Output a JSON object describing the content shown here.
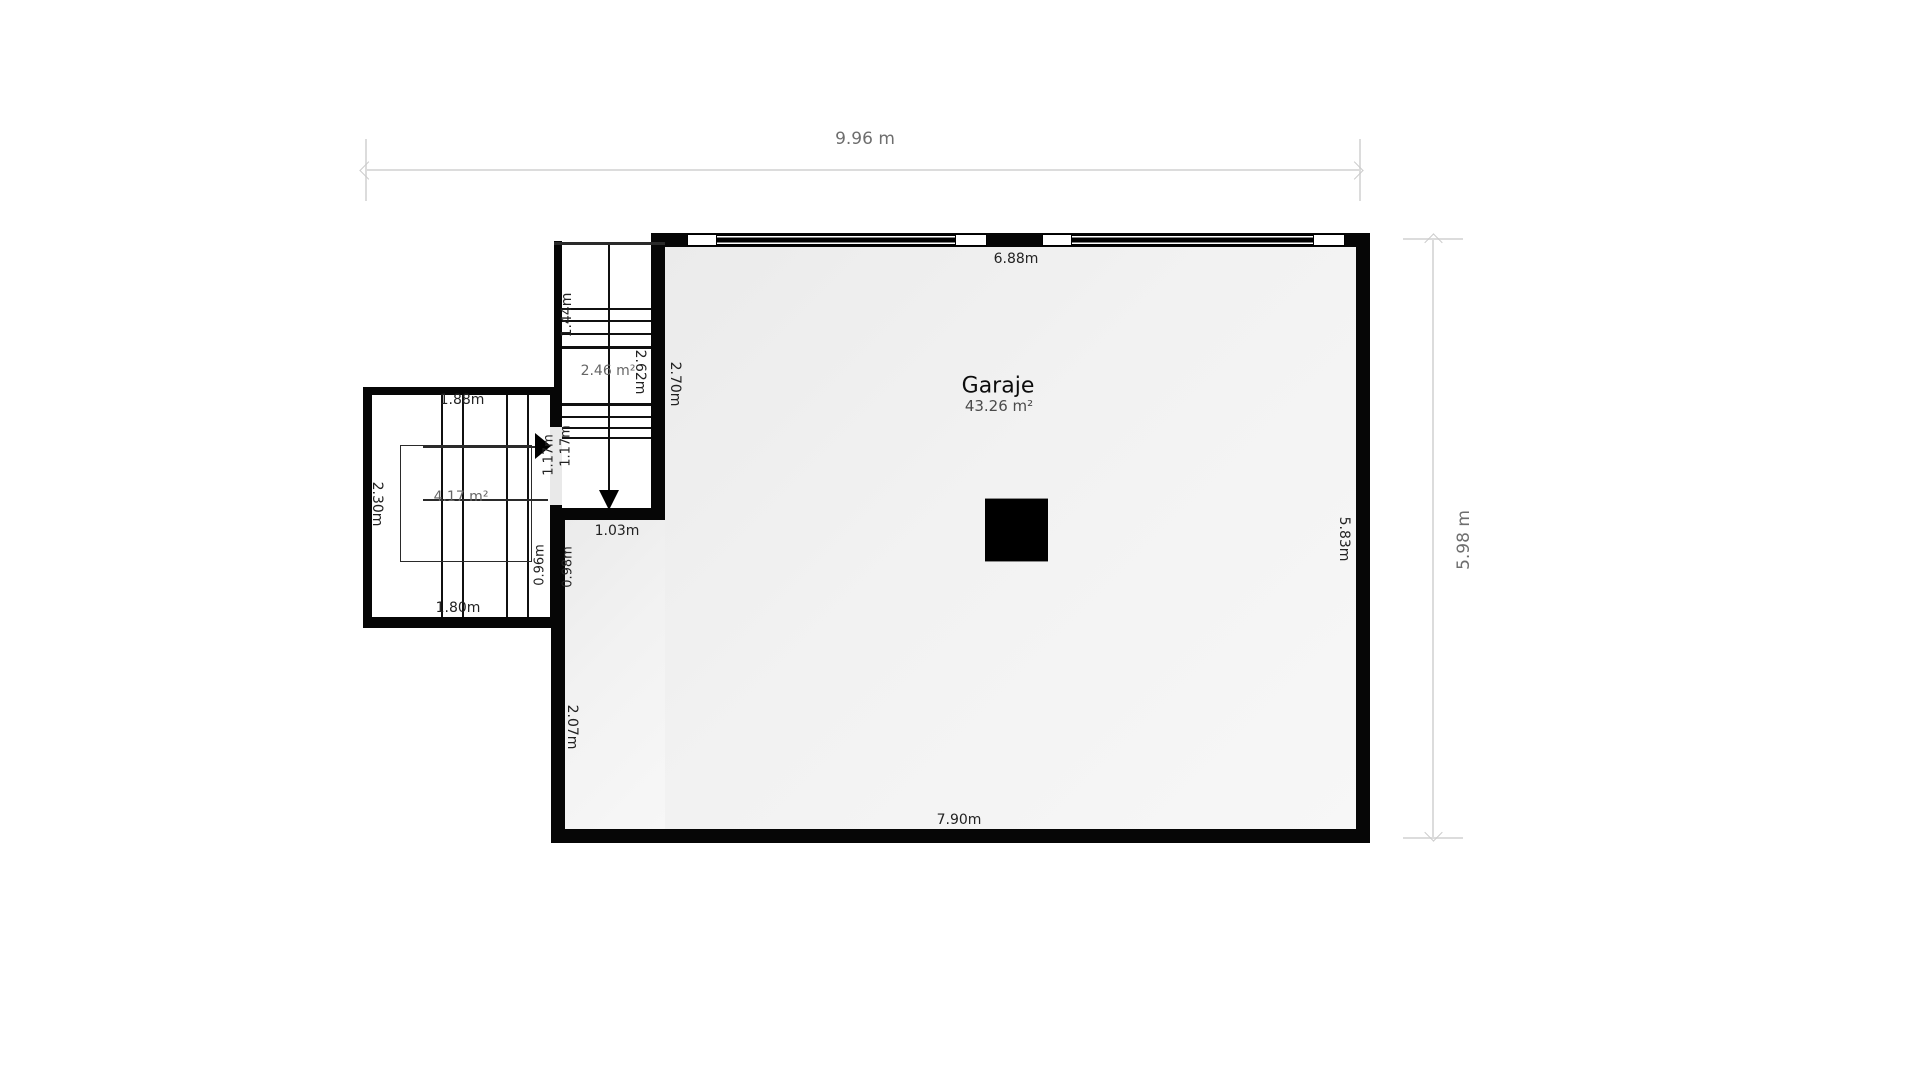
{
  "plan": {
    "overall": {
      "width_label": "9.96 m",
      "height_label": "5.98 m"
    },
    "garage": {
      "name": "Garaje",
      "area": "43.26 m²",
      "top_width": "6.88m",
      "right_height": "5.83m",
      "bottom_width": "7.90m",
      "left_lower_height": "2.07m",
      "left_upper_height": "2.70m",
      "stair_opening_width": "1.03m"
    },
    "staircase": {
      "area": "2.46 m²",
      "length": "2.62m",
      "upper_flight_length": "1.44m"
    },
    "side_room": {
      "top_width": "1.88m",
      "left_height": "2.30m",
      "area": "4.17 m²",
      "bottom_width": "1.80m",
      "door_width_a": "1.17m",
      "door_width_b": "1.17m",
      "wall_segment_a": "0.96m",
      "wall_segment_b": "0.98m"
    }
  }
}
